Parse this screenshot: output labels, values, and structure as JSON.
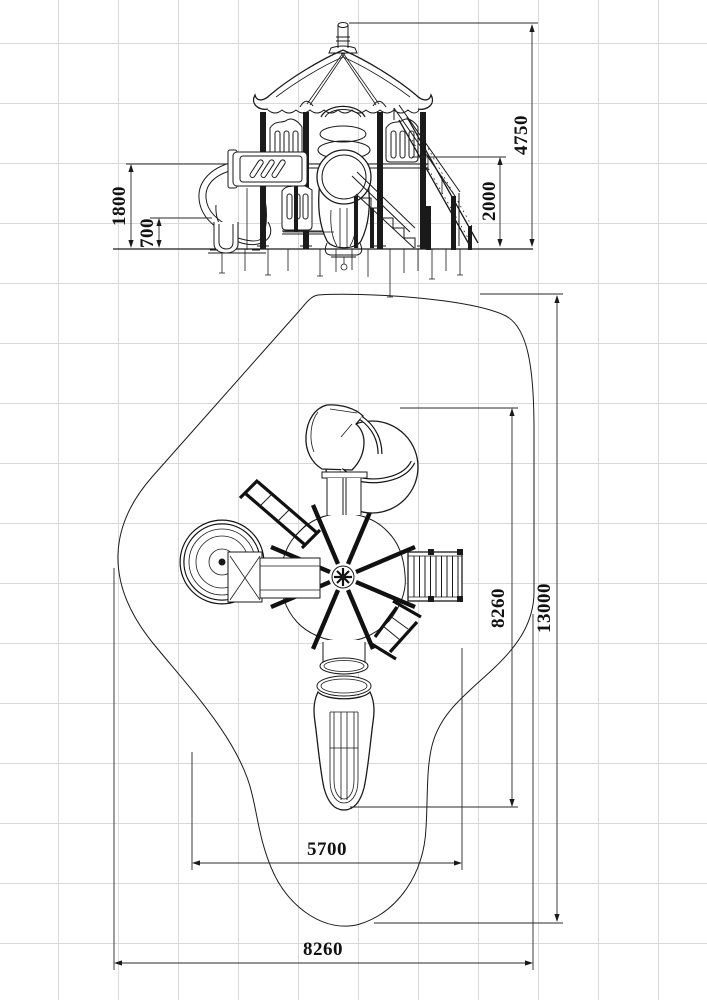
{
  "sheet": {
    "background_color": "#ffffff",
    "grid_color": "#d9d9d9",
    "line_color": "#1a1a1a"
  },
  "elevation_view": {
    "dimensions": {
      "total_height": "4750",
      "deck_height": "2000",
      "spiral_platform_height": "1800",
      "slide_exit_height": "700"
    }
  },
  "plan_view": {
    "dimensions": {
      "inner_length": "8260",
      "zone_length": "13000",
      "inner_width": "5700",
      "zone_width": "8260"
    }
  }
}
